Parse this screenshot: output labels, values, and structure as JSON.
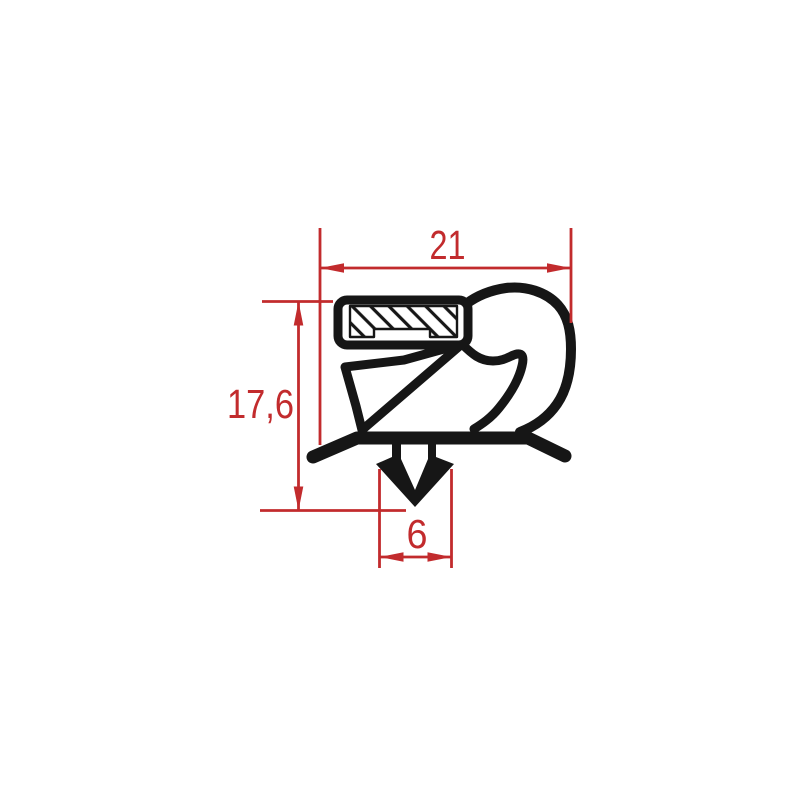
{
  "drawing": {
    "kind": "gasket-profile-cross-section",
    "dimensions": {
      "top_width": {
        "label": "21"
      },
      "left_height": {
        "label": "17,6"
      },
      "bottom_width": {
        "label": "6"
      }
    },
    "colors": {
      "dimension": "#c22b2d",
      "profile": "#161616",
      "pocket_fill": "#ffffff",
      "background": "#ffffff"
    }
  }
}
